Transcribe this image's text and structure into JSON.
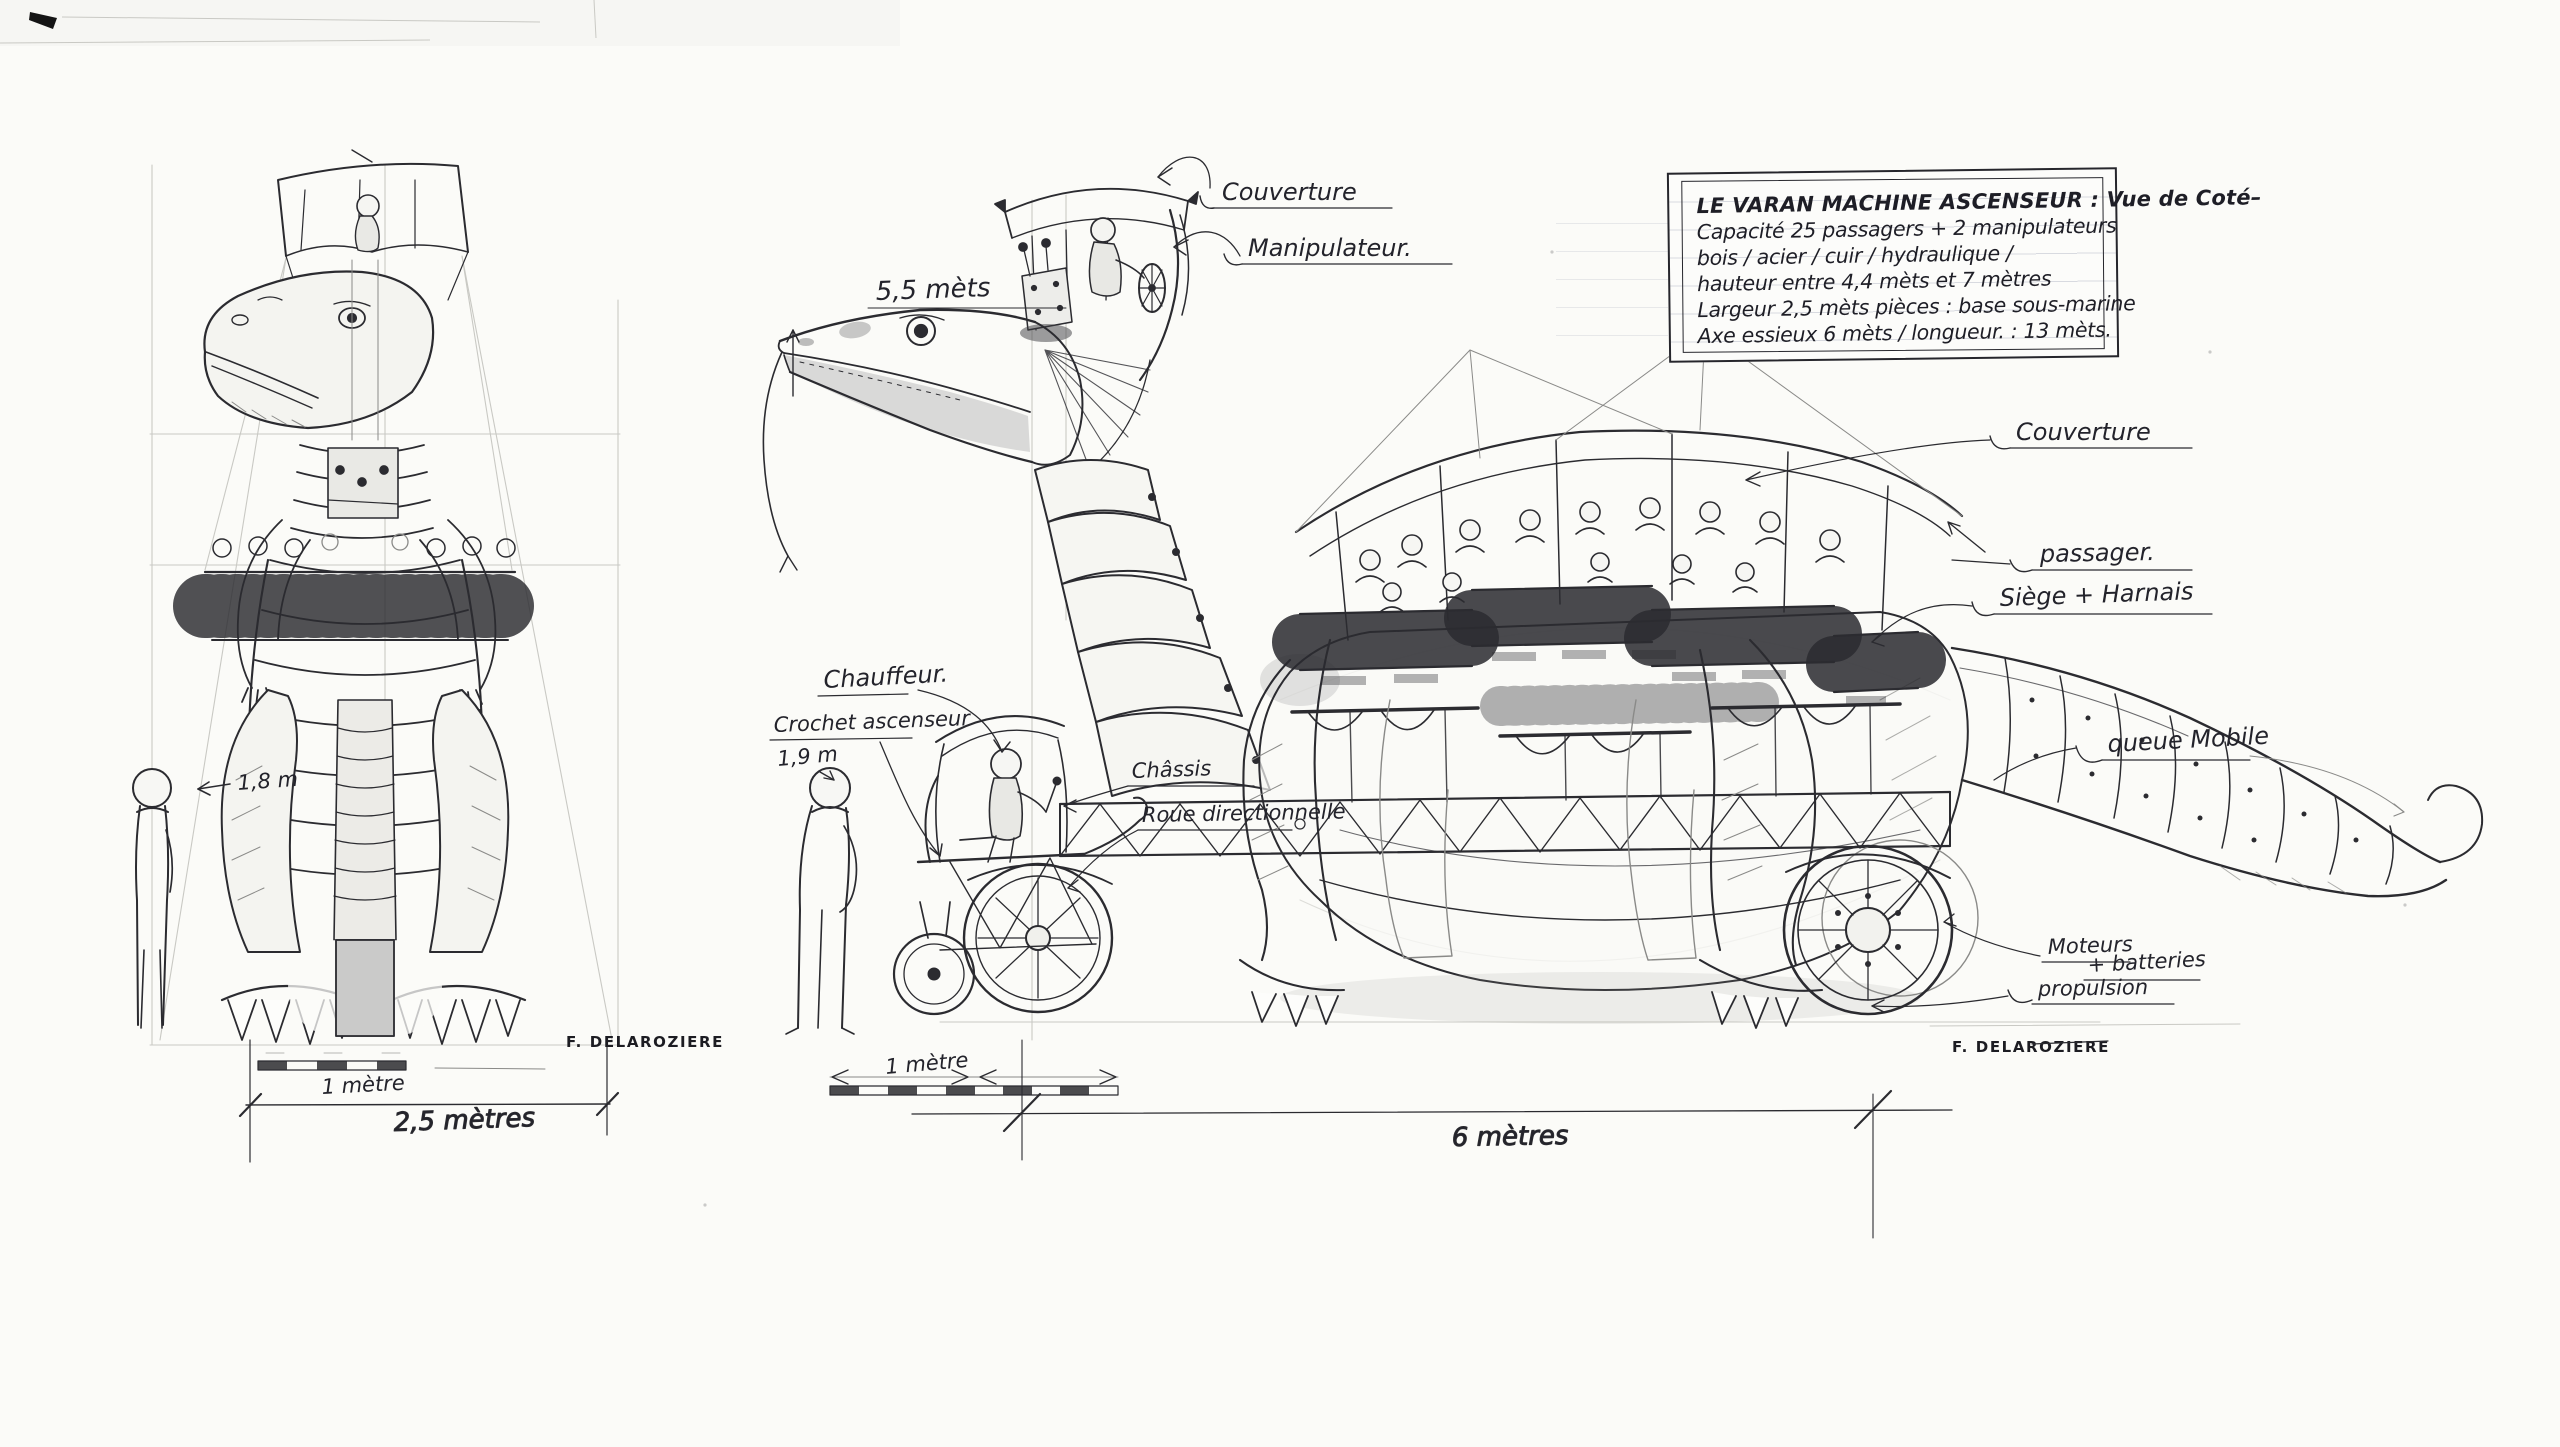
{
  "title_block": {
    "line1": "LE VARAN MACHINE ASCENSEUR : Vue de Coté–",
    "line2": "Capacité 25 passagers + 2 manipulateurs",
    "line3": "bois / acier / cuir / hydraulique /",
    "line4": "hauteur entre 4,4 mèts et 7 mètres",
    "line5": "Largeur 2,5 mèts    pièces : base sous-marine",
    "line6": "Axe essieux 6 mèts / longueur. : 13 mèts."
  },
  "side_view": {
    "labels": {
      "couverture_top": "Couverture",
      "manipulateur": "Manipulateur.",
      "head_height": "5,5 mèts",
      "chauffeur": "Chauffeur.",
      "crochet_ascenseur": "Crochet ascenseur",
      "person_height": "1,9 m",
      "chassis": "Châssis",
      "roue_directionnelle": "Roue directionnelle",
      "couverture_right": "Couverture",
      "passager": "passager.",
      "siege_harnais": "Siège + Harnais",
      "queue_mobile": "queue Mobile",
      "moteurs": "Moteurs",
      "batteries": "+ batteries",
      "propulsion": "propulsion"
    },
    "dimensions": {
      "scale_bar": "1 mètre",
      "axle_span": "6 mètres"
    },
    "signature": "F. DELAROZIERE"
  },
  "front_view": {
    "labels": {
      "person_height": "1,8 m"
    },
    "dimensions": {
      "scale_bar": "1 mètre",
      "overall_width": "2,5 mètres"
    },
    "signature": "F. DELAROZIERE"
  }
}
